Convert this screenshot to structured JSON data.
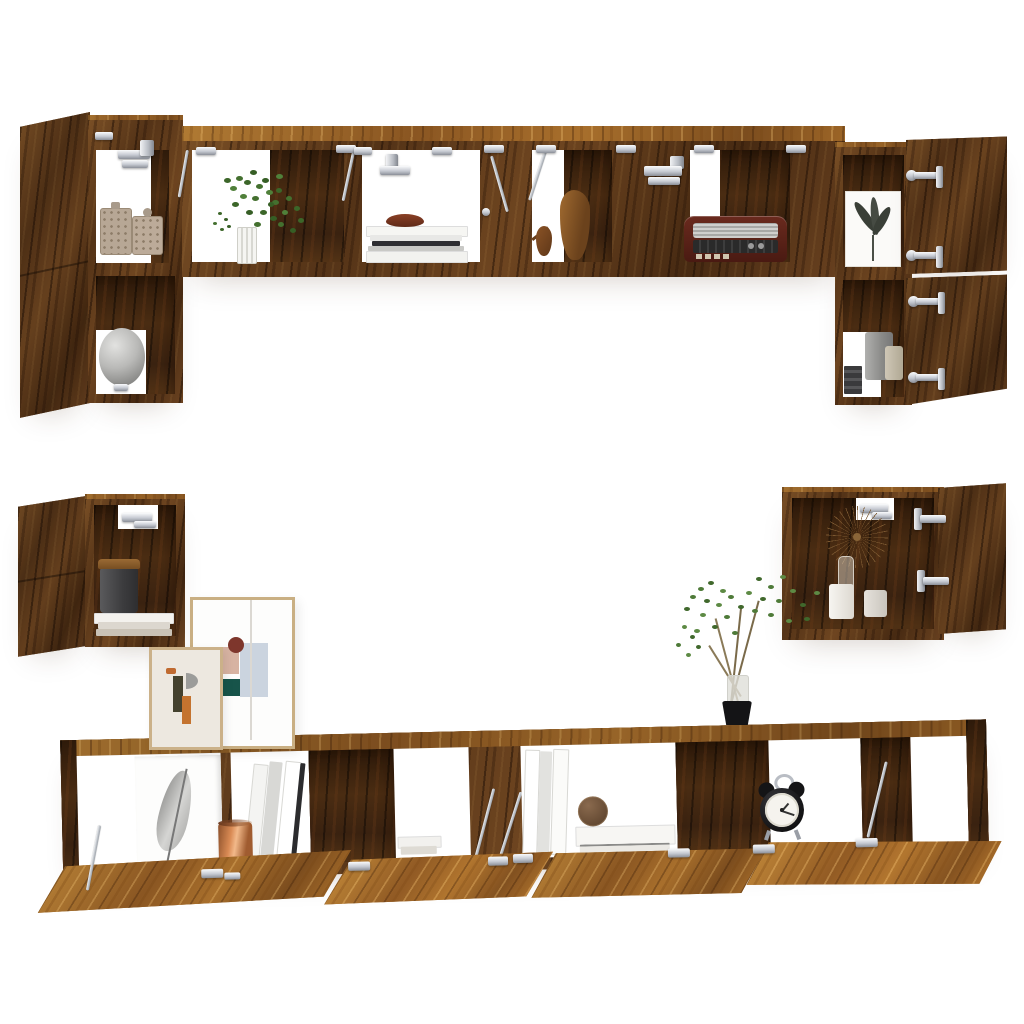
{
  "scene": {
    "description": "Product photo: smoked-oak engineered-wood TV wall-cabinet set shown open and styled with decor on a plain white background",
    "background": "#ffffff"
  },
  "furniture": {
    "top_wall_unit": {
      "left_tall_cabinet": {
        "door_state": "open to the left",
        "top_shelf_items": [
          "carved square jar",
          "carved jar with ball lid"
        ],
        "bottom_shelf_items": [
          "grey sphere vase on metal foot"
        ]
      },
      "long_wall_cabinet": {
        "flap_doors": "folded open upward",
        "compartments": [
          {
            "items": [
              "hanging green plant",
              "white ribbed vase"
            ]
          },
          {
            "items": [
              "stack of books and magazines",
              "brown bowl"
            ]
          },
          {
            "items": [
              "wooden bird figurine",
              "wooden gourd vase"
            ]
          },
          {
            "items": [
              "vintage radio"
            ]
          }
        ]
      },
      "right_tall_cabinet": {
        "door_state": "two doors open to the right",
        "top_shelf_items": [
          "leaf art print"
        ],
        "bottom_shelf_items": [
          "grey cup",
          "beige cup",
          "dark book stack"
        ]
      }
    },
    "left_wall_cube": {
      "door_state": "open to the left",
      "items": [
        "dark canister with wooden lid",
        "stack of books"
      ]
    },
    "right_wall_cube": {
      "door_state": "open to the right",
      "items": [
        "straw starburst decoration",
        "glass bottle",
        "white jar",
        "candle"
      ]
    },
    "tv_stand": {
      "flap_doors": "four flap doors folded open downward",
      "top_items": [
        "large abstract framed print",
        "small abstract framed print",
        "branch plant in glass vase with black pot"
      ],
      "compartments": [
        {
          "items": [
            "feather art board"
          ]
        },
        {
          "items": [
            "white binders",
            "copper cup"
          ]
        },
        {
          "items": [
            "small stack of books"
          ]
        },
        {
          "items": [
            "leaning white books",
            "stack of large white books",
            "two wicker balls"
          ]
        },
        {
          "items": [
            "black twin-bell alarm clock"
          ]
        }
      ]
    },
    "hardware": [
      "silver flap hinges",
      "silver gas stays",
      "silver cup hinges",
      "silver L-brackets"
    ]
  },
  "colors": {
    "bg": "#ffffff",
    "wood_mid": "#6a4220",
    "wood_light": "#a06a28",
    "wood_dark": "#3a2210",
    "silver": "#c9cdd4",
    "copper": "#c87e4a",
    "plant_green": "#4e7a38",
    "teal": "#17544a",
    "rust": "#7e362c",
    "pink": "#d7b3a2",
    "clock_black": "#1b1b1d",
    "sphere_grey": "#aaaaaa"
  }
}
